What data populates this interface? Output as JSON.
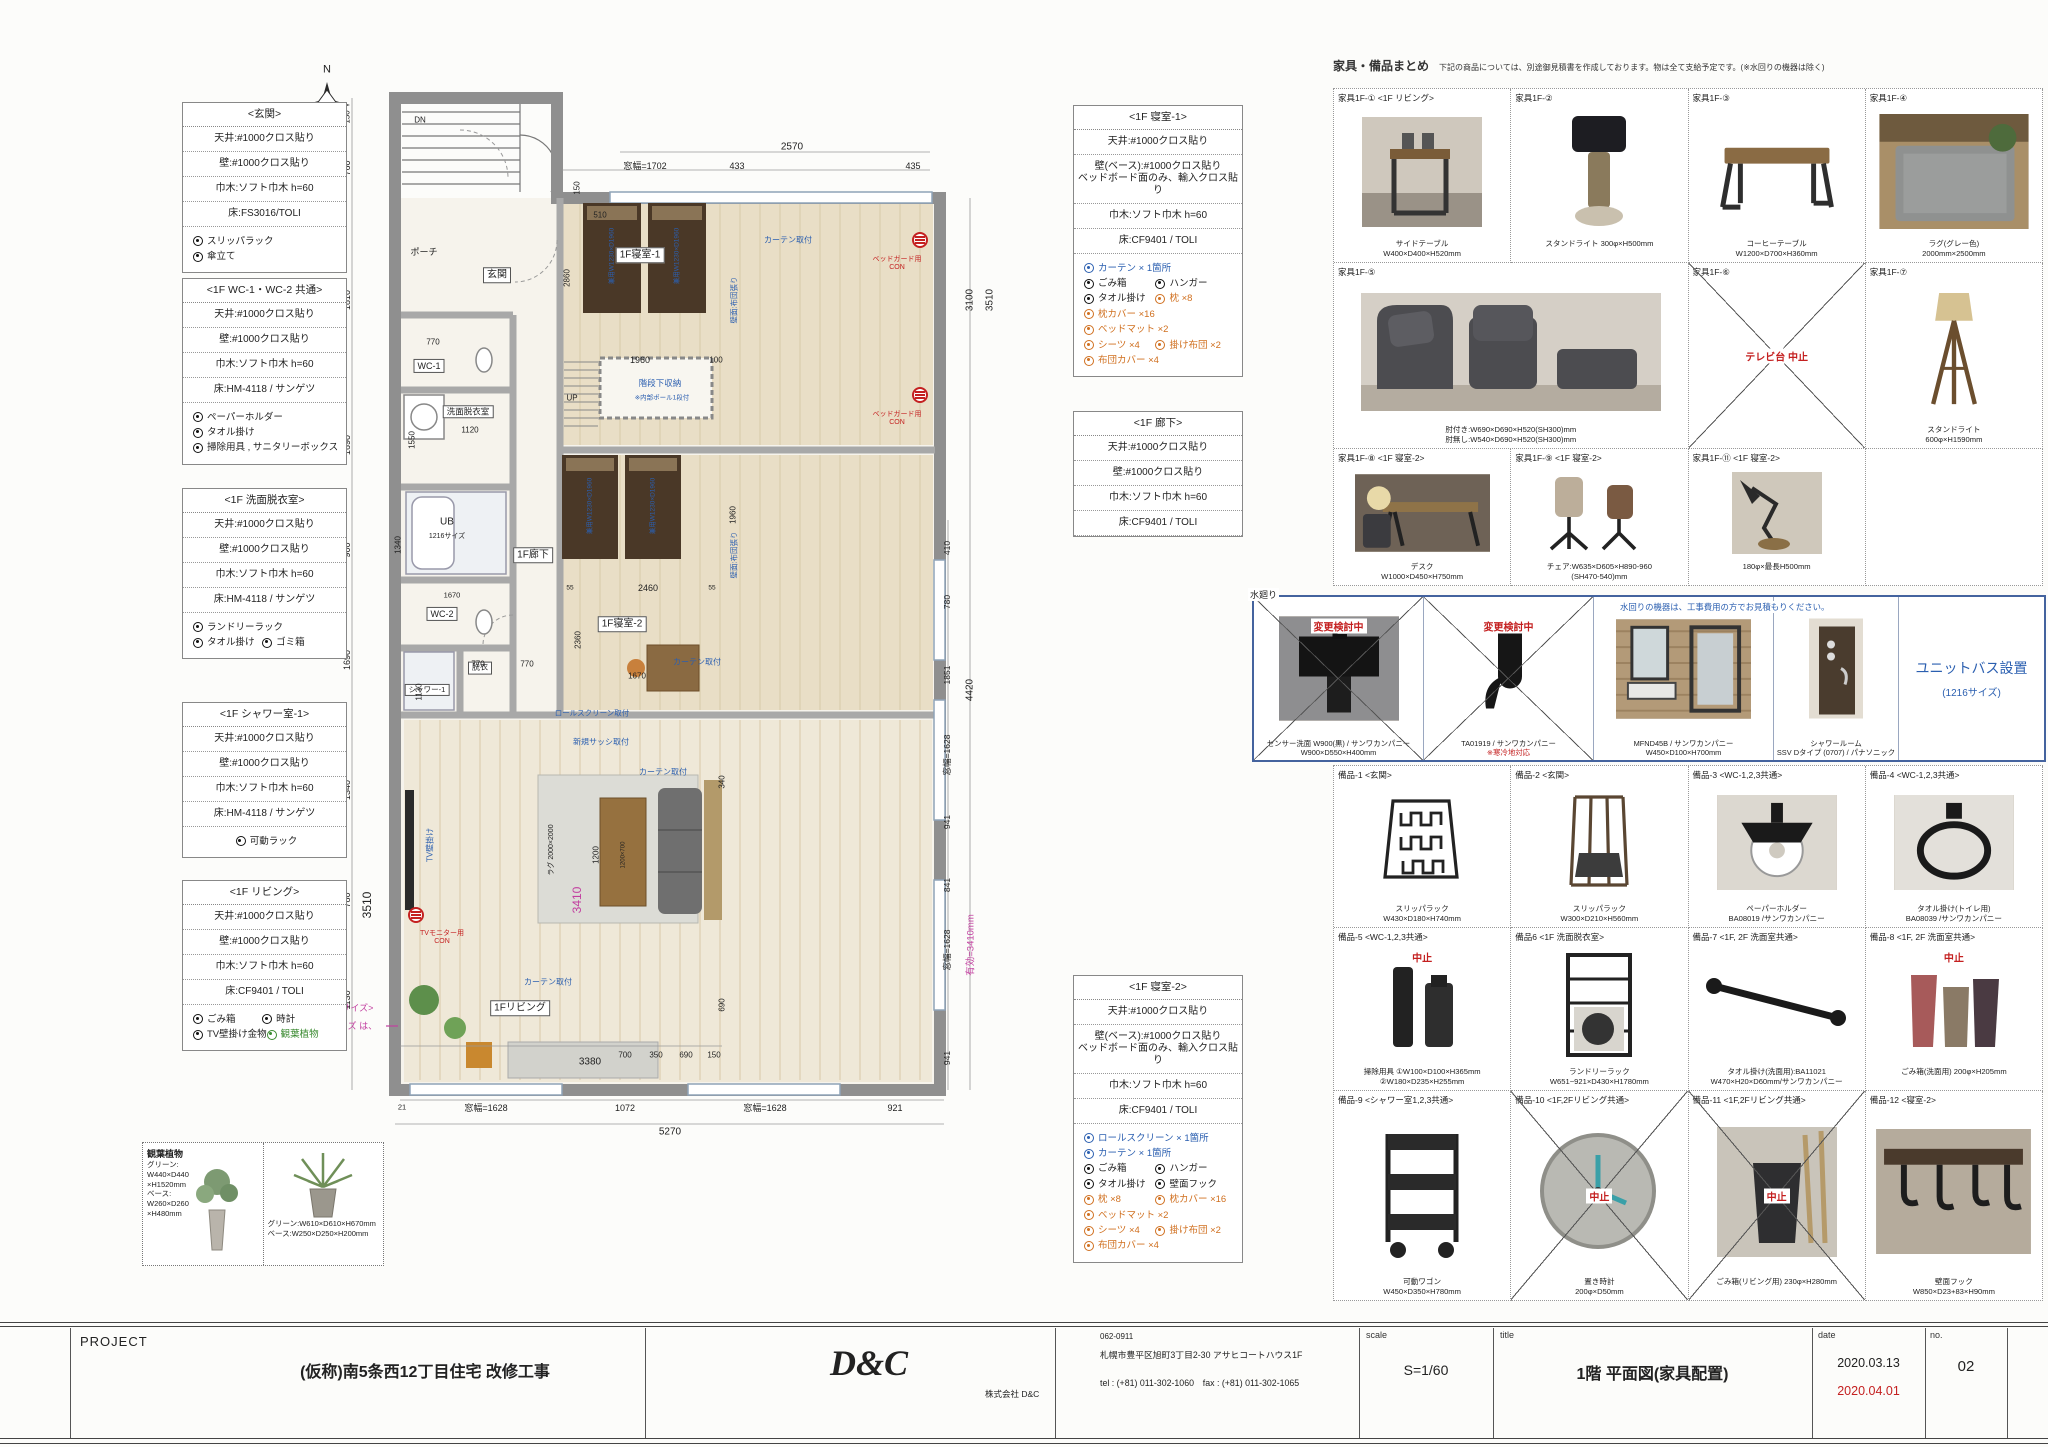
{
  "left_specs": [
    {
      "title": "<玄関>",
      "rows": [
        "天井:#1000クロス貼り",
        "壁:#1000クロス貼り",
        "巾木:ソフト巾木 h=60",
        "床:FS3016/TOLI"
      ],
      "checks": [
        {
          "t": "スリッパラック",
          "c": "k"
        },
        {
          "t": "傘立て",
          "c": "k"
        }
      ]
    },
    {
      "title": "<1F WC-1・WC-2 共通>",
      "rows": [
        "天井:#1000クロス貼り",
        "壁:#1000クロス貼り",
        "巾木:ソフト巾木 h=60",
        "床:HM-4118 / サンゲツ"
      ],
      "checks": [
        {
          "t": "ペーパーホルダー",
          "c": "k"
        },
        {
          "t": "タオル掛け",
          "c": "k"
        },
        {
          "t": "掃除用具 , サニタリーボックス",
          "c": "k"
        }
      ]
    },
    {
      "title": "<1F 洗面脱衣室>",
      "rows": [
        "天井:#1000クロス貼り",
        "壁:#1000クロス貼り",
        "巾木:ソフト巾木 h=60",
        "床:HM-4118 / サンゲツ"
      ],
      "checks": [
        {
          "t": "ランドリーラック",
          "c": "k"
        },
        {
          "t": "タオル掛け",
          "c": "k"
        },
        {
          "t": "ゴミ箱",
          "c": "k"
        }
      ]
    },
    {
      "title": "<1F シャワー室-1>",
      "rows": [
        "天井:#1000クロス貼り",
        "壁:#1000クロス貼り",
        "巾木:ソフト巾木 h=60",
        "床:HM-4118 / サンゲツ"
      ],
      "checks": [
        {
          "t": "可動ラック",
          "c": "k"
        }
      ]
    },
    {
      "title": "<1F リビング>",
      "rows": [
        "天井:#1000クロス貼り",
        "壁:#1000クロス貼り",
        "巾木:ソフト巾木 h=60",
        "床:CF9401 / TOLI"
      ],
      "checks": [
        {
          "t": "ごみ箱",
          "c": "k"
        },
        {
          "t": "時計",
          "c": "k"
        },
        {
          "t": "TV壁掛け金物",
          "c": "k"
        },
        {
          "t": "観葉植物",
          "c": "g"
        }
      ]
    }
  ],
  "mid_specs": [
    {
      "title": "<1F 寝室-1>",
      "rows": [
        "天井:#1000クロス貼り",
        "壁(ベース):#1000クロス貼り\nベッドボード面のみ、輸入クロス貼り",
        "巾木:ソフト巾木 h=60",
        "床:CF9401 / TOLI"
      ],
      "checks": [
        {
          "t": "カーテン × 1箇所",
          "c": "b"
        },
        {
          "t": "ごみ箱",
          "c": "k"
        },
        {
          "t": "ハンガー",
          "c": "k"
        },
        {
          "t": "タオル掛け",
          "c": "k"
        },
        {
          "t": "枕 ×8",
          "c": "o"
        },
        {
          "t": "枕カバー ×16",
          "c": "o"
        },
        {
          "t": "ベッドマット ×2",
          "c": "o"
        },
        {
          "t": "シーツ ×4",
          "c": "o"
        },
        {
          "t": "掛け布団 ×2",
          "c": "o"
        },
        {
          "t": "布団カバー ×4",
          "c": "o"
        }
      ]
    },
    {
      "title": "<1F 廊下>",
      "rows": [
        "天井:#1000クロス貼り",
        "壁:#1000クロス貼り",
        "巾木:ソフト巾木 h=60",
        "床:CF9401 / TOLI"
      ],
      "checks": []
    },
    {
      "title": "<1F 寝室-2>",
      "rows": [
        "天井:#1000クロス貼り",
        "壁(ベース):#1000クロス貼り\nベッドボード面のみ、輸入クロス貼り",
        "巾木:ソフト巾木 h=60",
        "床:CF9401 / TOLI"
      ],
      "checks": [
        {
          "t": "ロールスクリーン × 1箇所",
          "c": "b"
        },
        {
          "t": "カーテン × 1箇所",
          "c": "b"
        },
        {
          "t": "ごみ箱",
          "c": "k"
        },
        {
          "t": "ハンガー",
          "c": "k"
        },
        {
          "t": "タオル掛け",
          "c": "k"
        },
        {
          "t": "壁面フック",
          "c": "k"
        },
        {
          "t": "枕 ×8",
          "c": "o"
        },
        {
          "t": "枕カバー ×16",
          "c": "o"
        },
        {
          "t": "ベッドマット ×2",
          "c": "o"
        },
        {
          "t": "シーツ ×4",
          "c": "o"
        },
        {
          "t": "掛け布団 ×2",
          "c": "o"
        },
        {
          "t": "布団カバー ×4",
          "c": "o"
        }
      ]
    }
  ],
  "plants": {
    "title": "観葉植物",
    "p1": "グリーン:\nW440×D440\n×H1520mm\nベース:\nW260×D260\n×H480mm",
    "p2": "グリーン:W610×D610×H670mm\nベース:W250×D250×H200mm"
  },
  "catalog": {
    "header": {
      "title": "家具・備品まとめ",
      "note": "下記の商品については、別途御見積書を作成しております。物は全て支給予定です。(※水回りの機器は除く)"
    },
    "furniture": [
      {
        "id": "家具1F-①",
        "room": "<1F リビング>",
        "cap1": "サイドテーブル",
        "cap2": "W400×D400×H520mm"
      },
      {
        "id": "家具1F-②",
        "room": "",
        "cap1": "スタンドライト 300φ×H500mm",
        "cap2": ""
      },
      {
        "id": "家具1F-③",
        "room": "",
        "cap1": "コーヒーテーブル",
        "cap2": "W1200×D700×H360mm"
      },
      {
        "id": "家具1F-④",
        "room": "",
        "cap1": "ラグ(グレー色)",
        "cap2": "2000mm×2500mm"
      },
      {
        "id": "家具1F-⑤",
        "room": "",
        "cap1": "肘付き:W690×D690×H520(SH300)mm",
        "cap2": "肘無し:W540×D690×H520(SH300)mm"
      },
      {
        "id": "家具1F-⑥",
        "room": "",
        "cancel": "テレビ台 中止"
      },
      {
        "id": "家具1F-⑦",
        "room": "",
        "cap1": "スタンドライト",
        "cap2": "600φ×H1590mm"
      },
      {
        "id": "家具1F-⑧",
        "room": "<1F 寝室-2>",
        "cap1": "デスク",
        "cap2": "W1000×D450×H750mm"
      },
      {
        "id": "家具1F-⑨",
        "room": "<1F 寝室-2>",
        "cap1": "チェア:W635×D605×H890-960",
        "cap2": "(SH470-540)mm"
      },
      {
        "id": "家具1F-⑪",
        "room": "<1F 寝室-2>",
        "cap1": "180φ×最長H500mm",
        "cap2": ""
      }
    ],
    "plumbing": {
      "label": "水廻り",
      "note": "水回りの機器は、工事費用の方でお見積もりください。",
      "cells": [
        {
          "badge": "変更検討中",
          "cap1": "センサー洗面 W900(黒) / サンワカンパニー",
          "cap2": "W900×D550×H400mm"
        },
        {
          "badge": "変更検討中",
          "cap1": "TA01919 / サンワカンパニー",
          "cap2": "※寒冷地対応"
        },
        {
          "cap1": "MFND45B / サンワカンパニー",
          "cap2": "W450×D100×H700mm"
        },
        {
          "cap1": "シャワールーム",
          "cap2": "SSV Dタイプ (0707) / パナソニック"
        }
      ],
      "unit_bath": {
        "l1": "ユニットバス設置",
        "l2": "(1216サイズ)"
      }
    },
    "accessories": [
      {
        "id": "備品-1",
        "room": "<玄関>",
        "cap1": "スリッパラック",
        "cap2": "W430×D180×H740mm"
      },
      {
        "id": "備品-2",
        "room": "<玄関>",
        "cap1": "スリッパラック",
        "cap2": "W300×D210×H560mm"
      },
      {
        "id": "備品-3",
        "room": "<WC-1,2,3共通>",
        "cap1": "ペーパーホルダー",
        "cap2": "BA08019 /サンワカンパニー"
      },
      {
        "id": "備品-4",
        "room": "<WC-1,2,3共通>",
        "cap1": "タオル掛け(トイレ用)",
        "cap2": "BA08039 /サンワカンパニー"
      },
      {
        "id": "備品-5",
        "room": "<WC-1,2,3共通>",
        "cap1": "掃除用具 ①W100×D100×H365mm",
        "cap2": "②W180×D235×H255mm",
        "badge": "中止"
      },
      {
        "id": "備品6",
        "room": "<1F 洗面脱衣室>",
        "cap1": "ランドリーラック",
        "cap2": "W651~921×D430×H1780mm"
      },
      {
        "id": "備品-7",
        "room": "<1F, 2F 洗面室共通>",
        "cap1": "タオル掛け(洗面用):BA11021",
        "cap2": "W470×H20×D60mm/サンワカンパニー"
      },
      {
        "id": "備品-8",
        "room": "<1F, 2F 洗面室共通>",
        "cap1": "ごみ箱(洗面用) 200φ×H205mm",
        "cap2": "",
        "badge": "中止"
      },
      {
        "id": "備品-9",
        "room": "<シャワー室1,2,3共通>",
        "cap1": "可動ワゴン",
        "cap2": "W450×D350×H780mm"
      },
      {
        "id": "備品-10",
        "room": "<1F,2Fリビング共通>",
        "cap1": "置き時計",
        "cap2": "200φ×D50mm",
        "badge": "中止"
      },
      {
        "id": "備品-11",
        "room": "<1F,2Fリビング共通>",
        "cap1": "ごみ箱(リビング用) 230φ×H280mm",
        "cap2": "",
        "badge": "中止"
      },
      {
        "id": "備品-12",
        "room": "<寝室-2>",
        "cap1": "壁面フック",
        "cap2": "W850×D23+83×H90mm"
      }
    ]
  },
  "titleblock": {
    "project_label": "PROJECT",
    "project_name": "(仮称)南5条西12丁目住宅 改修工事",
    "logo": "D&C",
    "company": "株式会社 D&C",
    "postal": "062-0911",
    "address": "札幌市豊平区旭町3丁目2-30 アサヒコートハウス1F",
    "telfax": "tel : (+81) 011-302-1060　fax : (+81) 011-302-1065",
    "scale_label": "scale",
    "scale": "S=1/60",
    "title_label": "title",
    "title": "1階 平面図(家具配置)",
    "date_label": "date",
    "date1": "2020.03.13",
    "date2": "2020.04.01",
    "no_label": "no.",
    "no": "02"
  },
  "plan": {
    "labels": [
      {
        "t": "N",
        "x": 327,
        "y": 70,
        "fs": 11
      },
      {
        "t": "ポーチ",
        "x": 424,
        "y": 252,
        "fs": 9
      },
      {
        "t": "DN",
        "x": 420,
        "y": 120,
        "fs": 8
      },
      {
        "t": "玄関",
        "x": 497,
        "y": 275,
        "c": "w",
        "fs": 10
      },
      {
        "t": "WC-1",
        "x": 429,
        "y": 366,
        "c": "w",
        "fs": 9
      },
      {
        "t": "洗面脱衣室",
        "x": 468,
        "y": 412,
        "c": "w",
        "fs": 8.5
      },
      {
        "t": "UB",
        "x": 447,
        "y": 522,
        "fs": 10
      },
      {
        "t": "1216サイズ",
        "x": 447,
        "y": 537,
        "fs": 7
      },
      {
        "t": "1F廊下",
        "x": 533,
        "y": 555,
        "c": "w",
        "fs": 10
      },
      {
        "t": "WC-2",
        "x": 442,
        "y": 614,
        "c": "w",
        "fs": 9
      },
      {
        "t": "脱衣",
        "x": 480,
        "y": 668,
        "c": "w",
        "fs": 8
      },
      {
        "t": "シャワー-1",
        "x": 427,
        "y": 690,
        "c": "w",
        "fs": 7.5
      },
      {
        "t": "UP",
        "x": 572,
        "y": 398,
        "fs": 8
      },
      {
        "t": "1F寝室-1",
        "x": 640,
        "y": 255,
        "c": "w",
        "fs": 10
      },
      {
        "t": "1F寝室-2",
        "x": 622,
        "y": 624,
        "c": "w",
        "fs": 10
      },
      {
        "t": "1Fリビング",
        "x": 520,
        "y": 1008,
        "c": "w",
        "fs": 10
      },
      {
        "t": "階段下収納",
        "x": 660,
        "y": 384,
        "c": "b",
        "fs": 8.5
      },
      {
        "t": "※内部ポール1段付",
        "x": 662,
        "y": 398,
        "c": "b",
        "fs": 6.5
      },
      {
        "t": "カーテン取付",
        "x": 788,
        "y": 240,
        "c": "b",
        "fs": 8
      },
      {
        "t": "カーテン取付",
        "x": 697,
        "y": 662,
        "c": "b",
        "fs": 8
      },
      {
        "t": "カーテン取付",
        "x": 663,
        "y": 772,
        "c": "b",
        "fs": 8
      },
      {
        "t": "カーテン取付",
        "x": 548,
        "y": 982,
        "c": "b",
        "fs": 8
      },
      {
        "t": "壁面:布団張り",
        "x": 735,
        "y": 300,
        "r": -90,
        "c": "b",
        "fs": 7.5
      },
      {
        "t": "壁面:布団張り",
        "x": 735,
        "y": 555,
        "r": -90,
        "c": "b",
        "fs": 7.5
      },
      {
        "t": "新規サッシ取付",
        "x": 601,
        "y": 742,
        "c": "b",
        "fs": 8
      },
      {
        "t": "ロールスクリーン取付",
        "x": 592,
        "y": 714,
        "c": "b",
        "fs": 7.5
      },
      {
        "t": "TV壁掛け",
        "x": 430,
        "y": 845,
        "r": -90,
        "c": "b",
        "fs": 8
      },
      {
        "t": "兼用W1230×D1960",
        "x": 612,
        "y": 256,
        "r": -90,
        "c": "b",
        "fs": 6.5
      },
      {
        "t": "兼用W1230×D1960",
        "x": 677,
        "y": 256,
        "r": -90,
        "c": "b",
        "fs": 6.5
      },
      {
        "t": "兼用W1230×D1960",
        "x": 590,
        "y": 506,
        "r": -90,
        "c": "b",
        "fs": 6.5
      },
      {
        "t": "兼用W1230×D1960",
        "x": 653,
        "y": 506,
        "r": -90,
        "c": "b",
        "fs": 6.5
      },
      {
        "t": "ベッドガード用\nCON",
        "x": 897,
        "y": 264,
        "c": "r",
        "fs": 7
      },
      {
        "t": "ベッドガード用\nCON",
        "x": 897,
        "y": 419,
        "c": "r",
        "fs": 7
      },
      {
        "t": "TVモニター用\nCON",
        "x": 442,
        "y": 938,
        "c": "r",
        "fs": 7
      },
      {
        "t": "<テレビ サイズ>",
        "x": 340,
        "y": 1008,
        "c": "p",
        "fs": 9
      },
      {
        "t": "図面のサイズ は、",
        "x": 340,
        "y": 1026,
        "c": "p",
        "fs": 9
      },
      {
        "t": "70型です。",
        "x": 327,
        "y": 1044,
        "c": "p",
        "fs": 9
      },
      {
        "t": "3410",
        "x": 578,
        "y": 900,
        "r": -90,
        "c": "p",
        "fs": 12
      },
      {
        "t": "有効=3410mm",
        "x": 972,
        "y": 945,
        "r": -90,
        "c": "p",
        "fs": 9.5
      },
      {
        "t": "2570",
        "x": 792,
        "y": 147,
        "fs": 10
      },
      {
        "t": "433",
        "x": 737,
        "y": 166,
        "fs": 9
      },
      {
        "t": "窓幅=1702",
        "x": 645,
        "y": 166,
        "fs": 9
      },
      {
        "t": "435",
        "x": 913,
        "y": 166,
        "fs": 9
      },
      {
        "t": "150",
        "x": 577,
        "y": 188,
        "r": -90,
        "fs": 8
      },
      {
        "t": "150",
        "x": 347,
        "y": 117,
        "r": -90,
        "fs": 8
      },
      {
        "t": "760",
        "x": 347,
        "y": 168,
        "r": -90,
        "fs": 9
      },
      {
        "t": "1810",
        "x": 347,
        "y": 300,
        "r": -90,
        "fs": 9
      },
      {
        "t": "1690",
        "x": 347,
        "y": 445,
        "r": -90,
        "fs": 9
      },
      {
        "t": "900",
        "x": 347,
        "y": 550,
        "r": -90,
        "fs": 9
      },
      {
        "t": "1690",
        "x": 347,
        "y": 660,
        "r": -90,
        "fs": 9
      },
      {
        "t": "1340",
        "x": 347,
        "y": 790,
        "r": -90,
        "fs": 9
      },
      {
        "t": "780",
        "x": 347,
        "y": 900,
        "r": -90,
        "fs": 9
      },
      {
        "t": "1130",
        "x": 347,
        "y": 1000,
        "r": -90,
        "fs": 9
      },
      {
        "t": "3510",
        "x": 368,
        "y": 905,
        "r": -90,
        "fs": 12
      },
      {
        "t": "410",
        "x": 948,
        "y": 548,
        "r": -90,
        "fs": 8.5
      },
      {
        "t": "780",
        "x": 948,
        "y": 602,
        "r": -90,
        "fs": 8.5
      },
      {
        "t": "1851",
        "x": 948,
        "y": 675,
        "r": -90,
        "fs": 8.5
      },
      {
        "t": "窓幅=1628",
        "x": 948,
        "y": 755,
        "r": -90,
        "fs": 8.5
      },
      {
        "t": "941",
        "x": 948,
        "y": 822,
        "r": -90,
        "fs": 8.5
      },
      {
        "t": "841",
        "x": 948,
        "y": 885,
        "r": -90,
        "fs": 8.5
      },
      {
        "t": "窓幅=1628",
        "x": 948,
        "y": 950,
        "r": -90,
        "fs": 8.5
      },
      {
        "t": "941",
        "x": 948,
        "y": 1058,
        "r": -90,
        "fs": 8.5
      },
      {
        "t": "3100",
        "x": 970,
        "y": 300,
        "r": -90,
        "fs": 10
      },
      {
        "t": "3510",
        "x": 990,
        "y": 300,
        "r": -90,
        "fs": 10
      },
      {
        "t": "4420",
        "x": 970,
        "y": 690,
        "r": -90,
        "fs": 10
      },
      {
        "t": "21",
        "x": 402,
        "y": 1108,
        "fs": 7.5
      },
      {
        "t": "窓幅=1628",
        "x": 486,
        "y": 1108,
        "fs": 9
      },
      {
        "t": "1072",
        "x": 625,
        "y": 1108,
        "fs": 9
      },
      {
        "t": "窓幅=1628",
        "x": 765,
        "y": 1108,
        "fs": 9
      },
      {
        "t": "921",
        "x": 895,
        "y": 1108,
        "fs": 9
      },
      {
        "t": "5270",
        "x": 670,
        "y": 1132,
        "fs": 10
      },
      {
        "t": "510",
        "x": 600,
        "y": 215,
        "fs": 8
      },
      {
        "t": "2860",
        "x": 567,
        "y": 278,
        "r": -90,
        "fs": 8
      },
      {
        "t": "1960",
        "x": 640,
        "y": 360,
        "fs": 9
      },
      {
        "t": "100",
        "x": 716,
        "y": 360,
        "fs": 8
      },
      {
        "t": "2460",
        "x": 648,
        "y": 588,
        "fs": 9
      },
      {
        "t": "55",
        "x": 570,
        "y": 588,
        "fs": 6.5
      },
      {
        "t": "55",
        "x": 712,
        "y": 588,
        "fs": 6.5
      },
      {
        "t": "1960",
        "x": 733,
        "y": 515,
        "r": -90,
        "fs": 8
      },
      {
        "t": "2360",
        "x": 578,
        "y": 640,
        "r": -90,
        "fs": 8
      },
      {
        "t": "1670",
        "x": 637,
        "y": 676,
        "fs": 8
      },
      {
        "t": "770",
        "x": 478,
        "y": 664,
        "fs": 8
      },
      {
        "t": "770",
        "x": 527,
        "y": 664,
        "fs": 8
      },
      {
        "t": "1130",
        "x": 419,
        "y": 692,
        "r": -90,
        "fs": 8
      },
      {
        "t": "1670",
        "x": 452,
        "y": 596,
        "fs": 7.5
      },
      {
        "t": "1340",
        "x": 398,
        "y": 545,
        "r": -90,
        "fs": 8
      },
      {
        "t": "1550",
        "x": 412,
        "y": 440,
        "r": -90,
        "fs": 8
      },
      {
        "t": "1120",
        "x": 470,
        "y": 430,
        "fs": 8
      },
      {
        "t": "770",
        "x": 433,
        "y": 342,
        "fs": 8
      },
      {
        "t": "3380",
        "x": 590,
        "y": 1062,
        "fs": 10
      },
      {
        "t": "ラグ 2000×2000",
        "x": 552,
        "y": 850,
        "r": -90,
        "fs": 7
      },
      {
        "t": "1200",
        "x": 596,
        "y": 855,
        "r": -90,
        "fs": 8
      },
      {
        "t": "1200×700",
        "x": 624,
        "y": 855,
        "r": -90,
        "fs": 6
      },
      {
        "t": "700",
        "x": 625,
        "y": 1055,
        "fs": 8
      },
      {
        "t": "350",
        "x": 656,
        "y": 1055,
        "fs": 8
      },
      {
        "t": "690",
        "x": 686,
        "y": 1055,
        "fs": 8
      },
      {
        "t": "150",
        "x": 714,
        "y": 1055,
        "fs": 8
      },
      {
        "t": "340",
        "x": 722,
        "y": 782,
        "r": -90,
        "fs": 8
      },
      {
        "t": "690",
        "x": 722,
        "y": 1005,
        "r": -90,
        "fs": 8
      }
    ]
  }
}
